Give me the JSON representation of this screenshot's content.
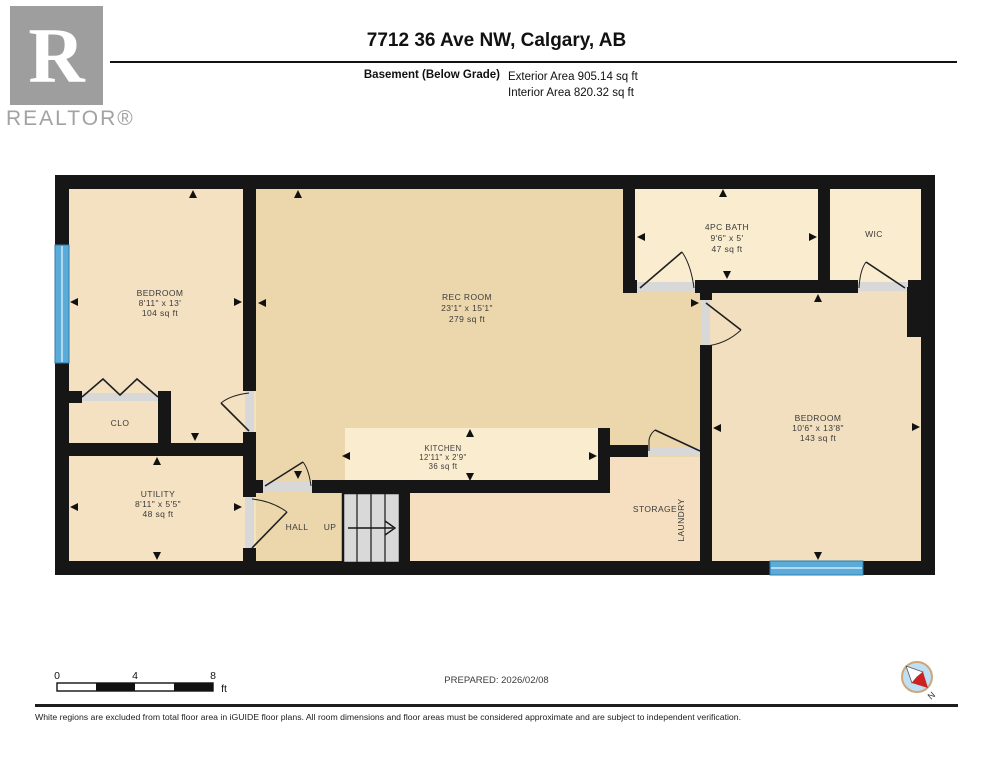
{
  "header": {
    "logo_letter": "R",
    "logo_word": "REALTOR®",
    "title": "7712 36 Ave NW, Calgary, AB",
    "floor_label": "Basement (Below Grade)",
    "exterior_area": "Exterior Area 905.14 sq ft",
    "interior_area": "Interior Area 820.32 sq ft"
  },
  "rooms": {
    "bedroom1": {
      "name": "BEDROOM",
      "dims": "8'11\" x 13'",
      "area": "104 sq ft"
    },
    "recroom": {
      "name": "REC ROOM",
      "dims": "23'1\" x 15'1\"",
      "area": "279 sq ft"
    },
    "bath": {
      "name": "4PC BATH",
      "dims": "9'6\" x 5'",
      "area": "47 sq ft"
    },
    "wic": {
      "name": "WIC"
    },
    "bedroom2": {
      "name": "BEDROOM",
      "dims": "10'6\" x 13'8\"",
      "area": "143 sq ft"
    },
    "clo": {
      "name": "CLO"
    },
    "utility": {
      "name": "UTILITY",
      "dims": "8'11\" x 5'5\"",
      "area": "48 sq ft"
    },
    "hall": {
      "name": "HALL"
    },
    "stairs": {
      "label": "UP"
    },
    "kitchen": {
      "name": "KITCHEN",
      "dims": "12'11\" x 2'9\"",
      "area": "36 sq ft"
    },
    "storage": {
      "name": "STORAGE",
      "name2": "LAUNDRY"
    }
  },
  "scale_bar": {
    "tick0": "0",
    "tick4": "4",
    "tick8": "8",
    "unit": "ft"
  },
  "prepared": "PREPARED: 2026/02/08",
  "compass": {
    "label": "N"
  },
  "footer": "White regions are excluded from total floor area in iGUIDE floor plans. All room dimensions and floor areas must be considered approximate and are subject to independent verification.",
  "colors": {
    "wall": "#161616",
    "window": "#5aabd8",
    "floor_tan": "#f3e1c1",
    "floor_dark_tan": "#ecd7ad",
    "floor_cream": "#faecce",
    "floor_storage": "#f5dfc0",
    "stairs_gray": "#d9d9d9",
    "compass_red": "#cc2222",
    "compass_blue": "#bee0f2"
  }
}
